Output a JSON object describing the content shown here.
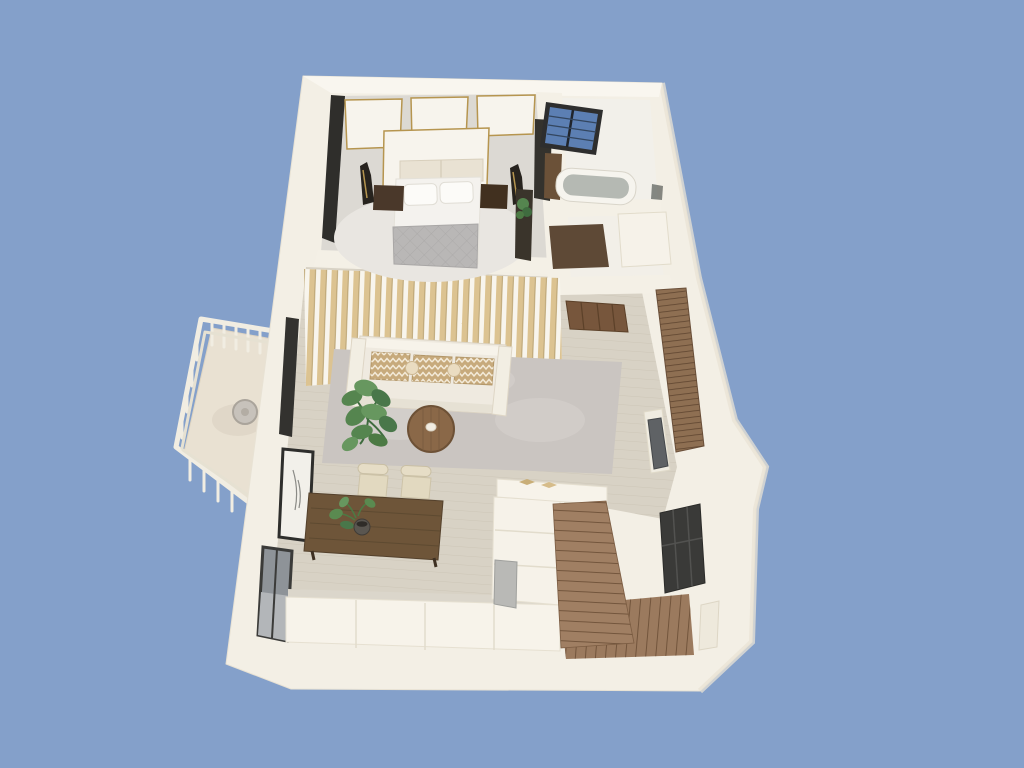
{
  "scene": {
    "description": "3D isometric architectural render of a one-bedroom apartment floor plan viewed from above, white walls on a solid blue background",
    "background_color": "#84a0ca",
    "colors": {
      "background": "#84a0ca",
      "exterior_wall": "#f3efe5",
      "wall_top": "#f9f6ef",
      "wall_divider": "#f4f0e6",
      "floor_wood": "#d8d2c5",
      "plank_line": "#c6beae",
      "bedroom_carpet": "#dcd9d3",
      "bedroom_rug": "#e9e6e1",
      "living_rug": "#cac5c1",
      "slat_wood": "#dcc391",
      "slat_edge": "#b89e68",
      "sofa": "#efeae0",
      "cushion": "#c7aa7c",
      "chevron": "#f3ead8",
      "coffee_table": "#8a6848",
      "dining_table": "#6e5539",
      "chair": "#e6ddc6",
      "plant_green": "#55854f",
      "plant_dark": "#3f6c3f",
      "stairs": "#9b7a5e",
      "step_line": "#6b4e36",
      "door_brown": "#77563c",
      "mat_brown": "#5e4936",
      "shelf": "#8e6f52",
      "tv": "#5f6265",
      "dark_panel": "#2f2e2b",
      "gold_trim": "#b6954f",
      "window_glass_blue": "#5c7fb3",
      "window_frame": "#2e2e2e",
      "tub": "#b5b9b3",
      "appliance": "#b9b9b6",
      "window_glass_gray": "#8e9398",
      "nightstand": "#4a382a",
      "quilt": "#b9b7b6",
      "bed_linen": "#f4f2ee",
      "railing": "#f1ede2",
      "balcony_floor": "#e9e1d2"
    },
    "rooms": [
      {
        "name": "bedroom",
        "furniture": [
          "double-bed",
          "nightstand-left",
          "nightstand-right",
          "statue-left",
          "statue-right",
          "gold-trim-wall-panels",
          "wardrobe",
          "console-with-plant"
        ]
      },
      {
        "name": "bathroom",
        "furniture": [
          "bathtub",
          "vanity",
          "blue-grid-window"
        ]
      },
      {
        "name": "walk-in-closet",
        "furniture": [
          "brown-rug",
          "storage-block"
        ]
      },
      {
        "name": "living-room",
        "furniture": [
          "sofa",
          "chevron-cushions",
          "round-coffee-table",
          "monstera-plant",
          "area-rug",
          "wood-slat-pergola",
          "tv-panel",
          "ladder-shelf",
          "open-brown-door"
        ]
      },
      {
        "name": "dining-area",
        "furniture": [
          "dining-table",
          "chair-1",
          "chair-2",
          "potted-plant",
          "framed-art",
          "window"
        ]
      },
      {
        "name": "kitchen",
        "furniture": [
          "counter-row",
          "island-counter",
          "gray-appliance",
          "counter-bar"
        ]
      },
      {
        "name": "stairwell",
        "furniture": [
          "upper-stair-flight",
          "lower-stair-flight",
          "dark-entry-door",
          "wall-niche"
        ]
      },
      {
        "name": "balcony",
        "furniture": [
          "white-railing",
          "round-side-table"
        ]
      }
    ]
  }
}
